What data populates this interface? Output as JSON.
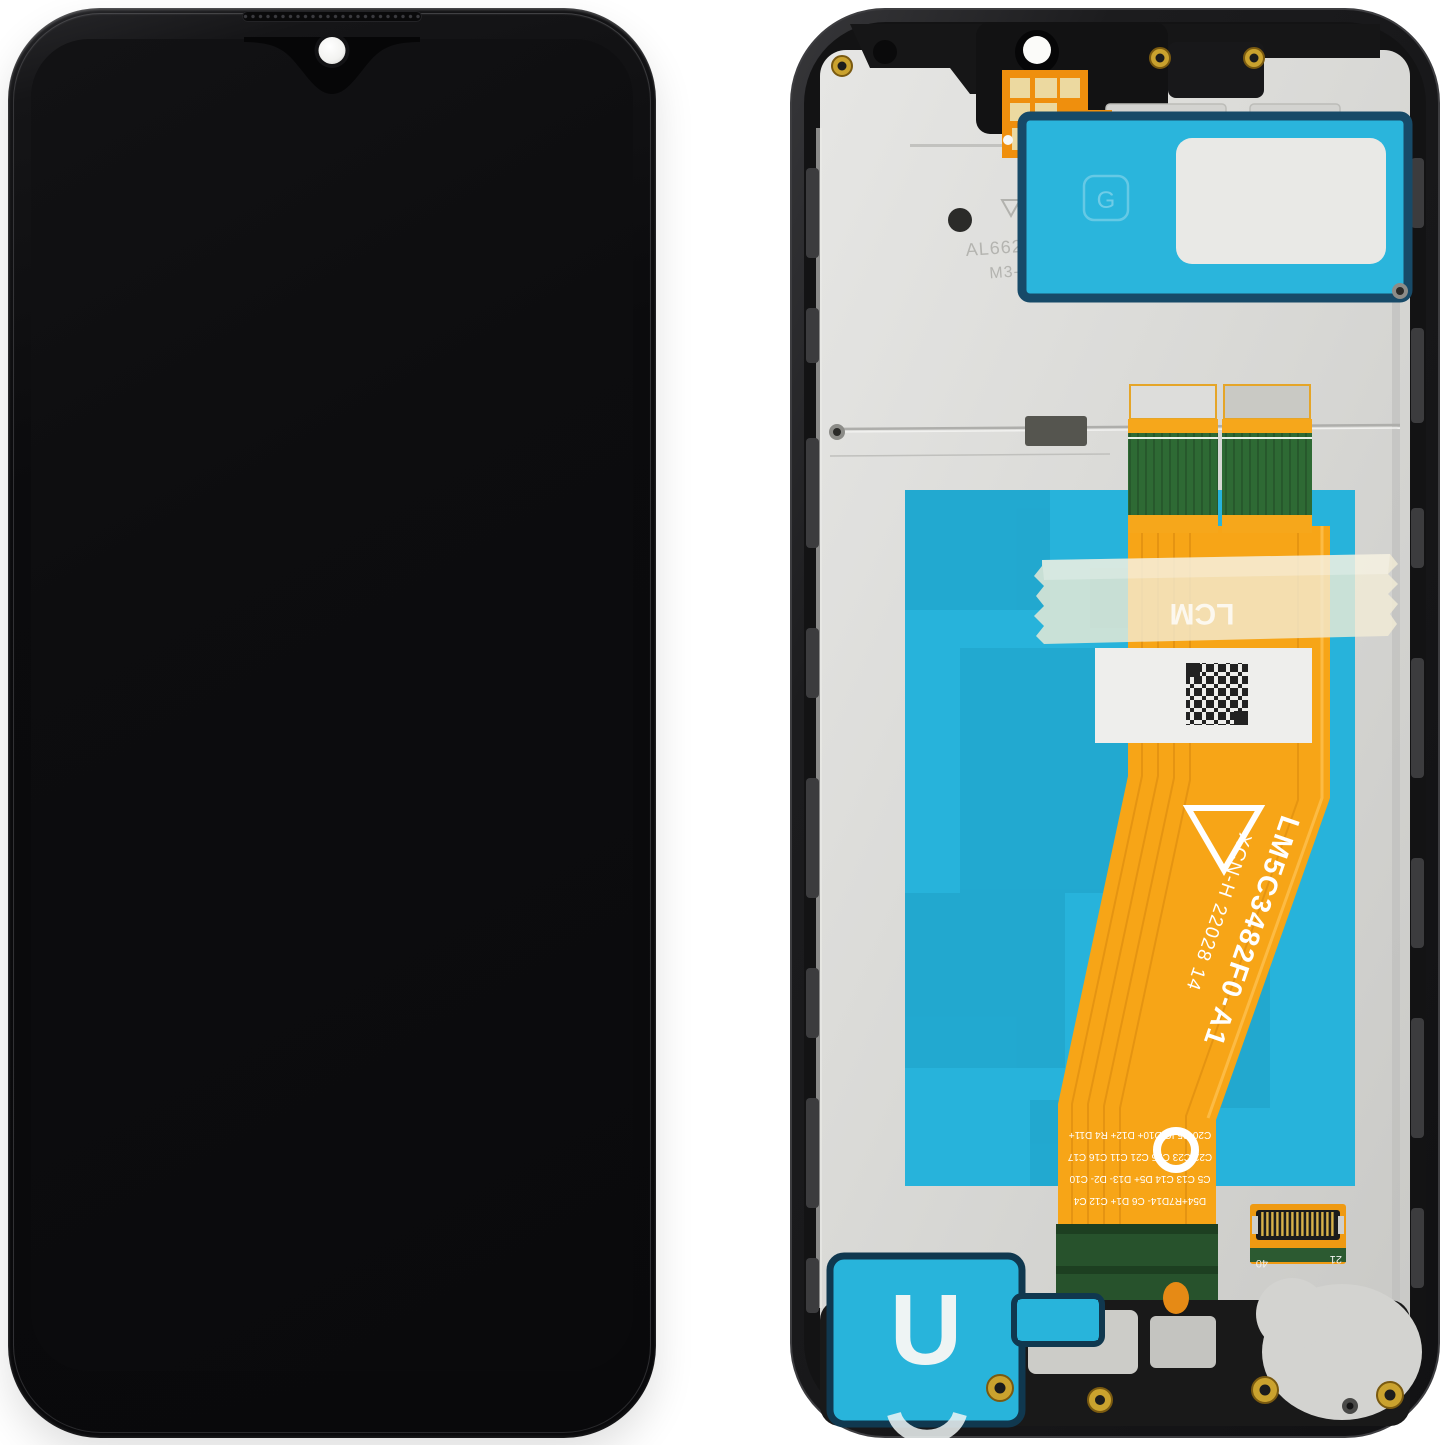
{
  "scene": {
    "title": "Smartphone LCD display assembly with frame, front and back view",
    "background": "#ffffff"
  },
  "front_view": {
    "frame_color": "#0b0b0d",
    "screen_color": "#0d0d0f",
    "camera_icon": "front-camera-hole",
    "earpiece_icon": "earpiece-speaker-grille"
  },
  "back_view": {
    "frame_color": "#1e1e20",
    "plate_color": "#d9d9d6",
    "accent_cyan": "#29b4db",
    "accent_orange": "#f6a41a",
    "pcb_green": "#2f6b35",
    "gold": "#c99a2e",
    "plate_markings": {
      "line1": "AL6626",
      "line2": "M3-1V0"
    },
    "g_mark": "G",
    "flex": {
      "model": "LM5C3482F0-A1",
      "batch_code": "XCN-H 22028 14",
      "lcm_label": "LCM",
      "component_labels": [
        "C20 R5 IC D10+ D12+ R4 D11+",
        "C22 C23 C15 C21 C11 C16 C17",
        "C5 C13 C14 D5+ D13- D2- C10",
        "D54+R7D14- C6 D1+ C12 C4"
      ]
    },
    "connector": {
      "left_marking": "40",
      "right_marking": "21"
    },
    "u_sticker_letter": "U"
  }
}
